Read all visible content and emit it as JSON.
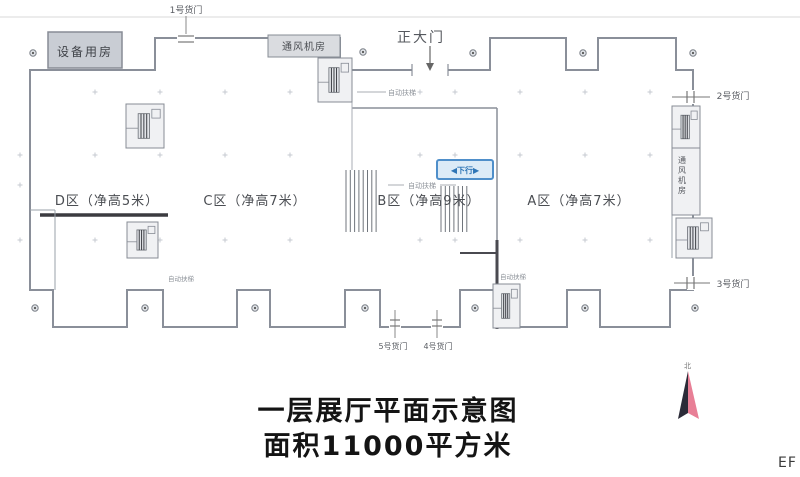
{
  "zones": {
    "d": "D区（净高5米）",
    "c": "C区（净高7米）",
    "b": "B区（净高9米）",
    "a": "A区（净高7米）"
  },
  "rooms": {
    "equipment": "设备用房",
    "vent_top": "通风机房",
    "vent_right": "通风机房"
  },
  "doors": {
    "main": "正大门",
    "no1": "1号货门",
    "no2": "2号货门",
    "no3": "3号货门",
    "no4": "4号货门",
    "no5": "5号货门"
  },
  "annotations": {
    "escalator_top": "自动扶梯",
    "escalator_b": "自动扶梯",
    "escalator_mid": "自动扶梯",
    "escalator_left": "自动扶梯",
    "down_badge": "◀下行▶"
  },
  "compass": {
    "north": "北"
  },
  "title": {
    "line1": "一层展厅平面示意图",
    "line2": "面积11000平方米"
  },
  "watermark": "EF",
  "colors": {
    "wall": "#8a8f99",
    "thick_wall": "#3b3b40",
    "badge_blue": "#2e75b6",
    "compass_dark": "#2b2b38",
    "compass_pink": "#e87f96",
    "room_fill": "#c9cdd4"
  }
}
